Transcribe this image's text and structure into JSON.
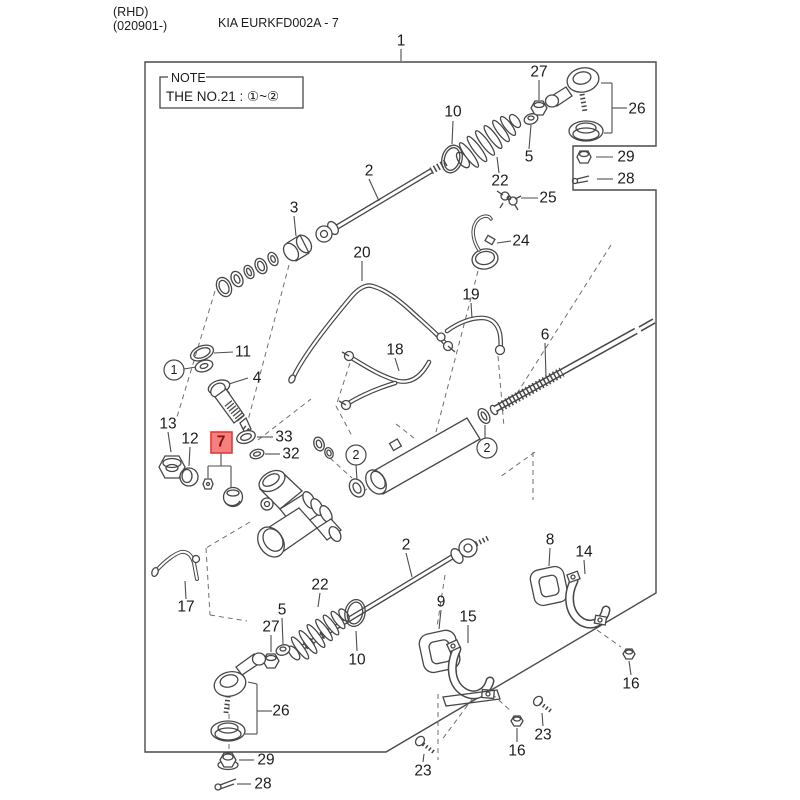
{
  "header": {
    "region_code": "(RHD)",
    "model_code": "(020901-)",
    "title": "KIA EURKFD002A - 7"
  },
  "note": {
    "legend": "NOTE",
    "text": "THE NO.21 : ①~②"
  },
  "highlight": {
    "selected_part": "7",
    "fill": "#f5807e",
    "stroke": "#e23a36",
    "text_color": "#7c1412"
  },
  "colors": {
    "line": "#474747",
    "text": "#1c1c1c",
    "leader": "#4d4d4d",
    "dashed": "#6f6f6f",
    "background": "#ffffff"
  },
  "callouts": [
    {
      "label": "1",
      "x": 401,
      "y": 41,
      "leaders": [
        [
          401,
          49,
          401,
          61
        ]
      ]
    },
    {
      "label": "27",
      "x": 539,
      "y": 72,
      "leaders": [
        [
          539,
          80,
          539,
          100
        ]
      ]
    },
    {
      "label": "26",
      "x": 637,
      "y": 109,
      "leaders": [
        [
          627,
          108,
          612,
          108
        ],
        [
          612,
          83,
          612,
          133
        ],
        [
          612,
          83,
          601,
          83
        ],
        [
          612,
          133,
          604,
          133
        ]
      ]
    },
    {
      "label": "29",
      "x": 626,
      "y": 157,
      "leaders": [
        [
          613,
          157,
          596,
          157
        ]
      ]
    },
    {
      "label": "28",
      "x": 626,
      "y": 179,
      "leaders": [
        [
          613,
          179,
          597,
          179
        ]
      ]
    },
    {
      "label": "10",
      "x": 453,
      "y": 112,
      "leaders": [
        [
          453,
          121,
          452,
          144
        ]
      ]
    },
    {
      "label": "5",
      "x": 529,
      "y": 157,
      "leaders": [
        [
          529,
          149,
          531,
          125
        ]
      ]
    },
    {
      "label": "22",
      "x": 500,
      "y": 181,
      "leaders": [
        [
          499,
          173,
          497,
          157
        ]
      ]
    },
    {
      "label": "25",
      "x": 548,
      "y": 198,
      "leaders": [
        [
          538,
          198,
          521,
          198
        ]
      ]
    },
    {
      "label": "24",
      "x": 521,
      "y": 241,
      "leaders": [
        [
          511,
          241,
          497,
          243
        ]
      ]
    },
    {
      "label": "2",
      "x": 369,
      "y": 171,
      "leaders": [
        [
          369,
          179,
          379,
          201
        ]
      ]
    },
    {
      "label": "3",
      "x": 294,
      "y": 208,
      "leaders": [
        [
          294,
          216,
          296,
          236
        ]
      ]
    },
    {
      "label": "20",
      "x": 362,
      "y": 253,
      "leaders": [
        [
          362,
          261,
          362,
          281
        ]
      ]
    },
    {
      "label": "19",
      "x": 471,
      "y": 295,
      "leaders": [
        [
          471,
          303,
          472,
          318
        ]
      ]
    },
    {
      "label": "18",
      "x": 395,
      "y": 350,
      "leaders": [
        [
          395,
          358,
          399,
          371
        ]
      ]
    },
    {
      "label": "6",
      "x": 545,
      "y": 335,
      "leaders": [
        [
          545,
          343,
          546,
          378
        ]
      ]
    },
    {
      "label": "11",
      "x": 243,
      "y": 352,
      "leaders": [
        [
          233,
          352,
          214,
          353
        ]
      ]
    },
    {
      "label": "1",
      "circled": true,
      "x": 174,
      "y": 370,
      "leaders": [
        [
          184,
          369,
          196,
          367
        ]
      ]
    },
    {
      "label": "4",
      "x": 257,
      "y": 378,
      "leaders": [
        [
          248,
          378,
          229,
          384
        ]
      ]
    },
    {
      "label": "33",
      "x": 284,
      "y": 437,
      "leaders": [
        [
          273,
          437,
          257,
          437
        ]
      ]
    },
    {
      "label": "32",
      "x": 291,
      "y": 454,
      "leaders": [
        [
          280,
          454,
          265,
          454
        ]
      ]
    },
    {
      "label": "13",
      "x": 168,
      "y": 424,
      "leaders": [
        [
          168,
          432,
          171,
          452
        ]
      ]
    },
    {
      "label": "12",
      "x": 190,
      "y": 439,
      "leaders": [
        [
          190,
          447,
          189,
          466
        ]
      ]
    },
    {
      "label": "7",
      "highlighted": true,
      "box": [
        211,
        432,
        21,
        21
      ],
      "x": 221,
      "y": 442,
      "leaders": [
        [
          221,
          453,
          221,
          466
        ],
        [
          208,
          466,
          231,
          466
        ],
        [
          208,
          466,
          208,
          478
        ],
        [
          231,
          466,
          231,
          487
        ]
      ]
    },
    {
      "label": "2",
      "circled": true,
      "x": 356,
      "y": 455,
      "leaders": [
        [
          356,
          465,
          357,
          480
        ]
      ]
    },
    {
      "label": "2",
      "circled": true,
      "x": 487,
      "y": 448,
      "leaders": [
        [
          485,
          438,
          485,
          425
        ]
      ]
    },
    {
      "label": "17",
      "x": 186,
      "y": 607,
      "leaders": [
        [
          186,
          599,
          185,
          581
        ]
      ]
    },
    {
      "label": "2",
      "x": 406,
      "y": 545,
      "leaders": [
        [
          406,
          553,
          412,
          577
        ]
      ]
    },
    {
      "label": "22",
      "x": 320,
      "y": 585,
      "leaders": [
        [
          320,
          593,
          318,
          607
        ]
      ]
    },
    {
      "label": "5",
      "x": 282,
      "y": 610,
      "leaders": [
        [
          282,
          618,
          283,
          644
        ]
      ]
    },
    {
      "label": "27",
      "x": 271,
      "y": 627,
      "leaders": [
        [
          271,
          635,
          271,
          652
        ]
      ]
    },
    {
      "label": "26",
      "x": 281,
      "y": 711,
      "leaders": [
        [
          272,
          711,
          257,
          711
        ],
        [
          257,
          684,
          257,
          734
        ],
        [
          257,
          684,
          248,
          682
        ],
        [
          257,
          734,
          245,
          734
        ]
      ]
    },
    {
      "label": "10",
      "x": 357,
      "y": 660,
      "leaders": [
        [
          357,
          651,
          356,
          631
        ]
      ]
    },
    {
      "label": "9",
      "x": 441,
      "y": 602,
      "leaders": [
        [
          441,
          610,
          439,
          629
        ]
      ]
    },
    {
      "label": "15",
      "x": 468,
      "y": 617,
      "leaders": [
        [
          468,
          625,
          468,
          643
        ]
      ]
    },
    {
      "label": "8",
      "x": 550,
      "y": 540,
      "leaders": [
        [
          550,
          548,
          549,
          566
        ]
      ]
    },
    {
      "label": "14",
      "x": 584,
      "y": 552,
      "leaders": [
        [
          584,
          560,
          585,
          574
        ]
      ]
    },
    {
      "label": "16",
      "x": 631,
      "y": 684,
      "leaders": [
        [
          631,
          675,
          629,
          661
        ]
      ]
    },
    {
      "label": "16",
      "x": 517,
      "y": 751,
      "leaders": [
        [
          517,
          742,
          517,
          728
        ]
      ]
    },
    {
      "label": "23",
      "x": 543,
      "y": 735,
      "leaders": [
        [
          543,
          726,
          542,
          713
        ]
      ]
    },
    {
      "label": "23",
      "x": 423,
      "y": 771,
      "leaders": [
        [
          423,
          762,
          424,
          754
        ]
      ]
    },
    {
      "label": "29",
      "x": 266,
      "y": 760,
      "leaders": [
        [
          254,
          760,
          239,
          760
        ]
      ]
    },
    {
      "label": "28",
      "x": 263,
      "y": 784,
      "leaders": [
        [
          251,
          784,
          237,
          784
        ]
      ]
    }
  ]
}
